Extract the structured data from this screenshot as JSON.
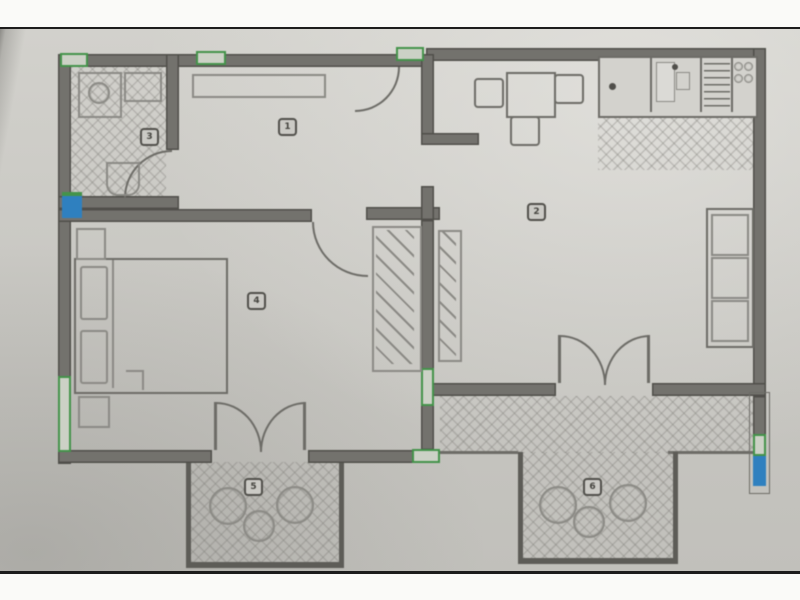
{
  "plan": {
    "kind": "scanned apartment floor plan photo",
    "rooms_present": [
      "hall",
      "living-kitchen",
      "bathroom",
      "bedroom",
      "terrace-left",
      "terrace-right"
    ]
  },
  "badges": {
    "hall": "1",
    "living": "2",
    "bathroom": "3",
    "bedroom": "4",
    "terrace_left": "5",
    "terrace_right": "6"
  },
  "symbols": {
    "wall": "thick gray bar",
    "window-marker": "green outlined wall segment",
    "junction-marker": "blue square",
    "door": "quarter-circle arc",
    "french-door": "double arc M shape",
    "tile-floor": "diamond cross-hatch",
    "radiator": "diagonal ticked strip",
    "wardrobe": "diagonal ticked box"
  },
  "colors": {
    "paper": "#c9c8c3",
    "wall": "#73726d",
    "wall-dark": "#504f4a",
    "line": "#8b8a85",
    "line-dark": "#6d6c67",
    "hatch": "rgba(122,121,116,0.30)",
    "green": "#44934a",
    "blue": "#2f80bf",
    "frame-white": "#fafaf8",
    "frame-black": "#1c1c1c"
  }
}
